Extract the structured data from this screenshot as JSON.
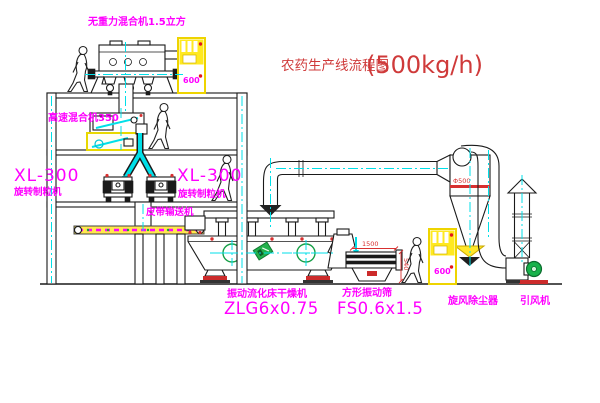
{
  "diagram_title": {
    "text": "农药生产线流程图",
    "capacity": "(500kg/h)"
  },
  "labels": {
    "gravity_mixer": "无重力混合机1.5立方",
    "high_speed_mixer": "高速混合机350",
    "granulator_left_model": "XL-300",
    "granulator_left_name": "旋转制粒机",
    "granulator_right_model": "XL-300",
    "granulator_right_name": "旋转制粒机",
    "belt_conveyor": "皮带输送机",
    "dryer_name": "振动流化床干燥机",
    "dryer_model": "ZLG6x0.75",
    "sieve_name": "方形振动筛",
    "sieve_model": "FS0.6x1.5",
    "cyclone_name": "旋风除尘器",
    "fan_name": "引风机",
    "cabinet_panel": "600"
  },
  "dimensions": {
    "sieve_length": "1500",
    "sieve_height": "540",
    "cyclone_diameter": "Φ500"
  },
  "colors": {
    "line": "#1a1a1a",
    "centerline_cyan": "#00dfe8",
    "label_magenta": "#ff00ff",
    "title_red": "#cf3a3a",
    "dimension_red": "#d83030",
    "equipment_yellow": "#ffe920",
    "motor_green": "#18b24b"
  }
}
